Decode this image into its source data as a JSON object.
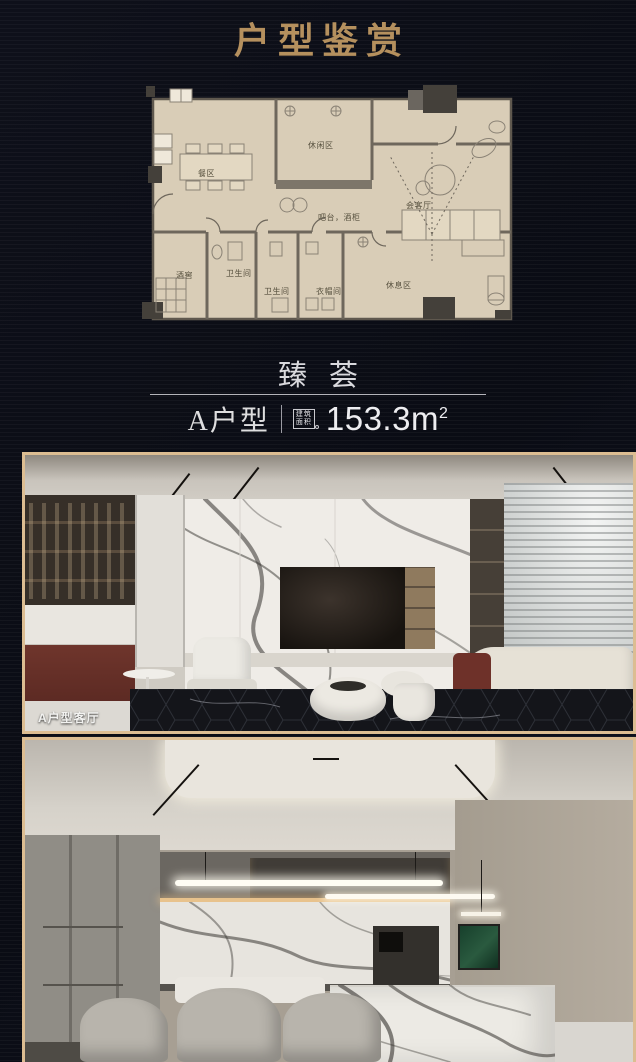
{
  "header": {
    "title": "户型鉴赏",
    "accent_color": "#b5905e"
  },
  "floorplan": {
    "bg_color": "#d9cdb7",
    "rooms": {
      "leisure": "休闲区",
      "dining": "餐区",
      "reception": "会客厅",
      "bar": "吧台，酒柜",
      "cellar": "酒窖",
      "bath1": "卫生间",
      "bath2": "卫生间",
      "cloak": "衣帽间",
      "rest": "休息区"
    }
  },
  "unit": {
    "name": "臻荟",
    "model": "A户型",
    "area_label_1": "建筑",
    "area_label_2": "面积",
    "area_value": "153.3m",
    "area_sup": "2"
  },
  "photos": {
    "frame_color": "#dcbd92",
    "living_caption": "A户型客厅"
  }
}
